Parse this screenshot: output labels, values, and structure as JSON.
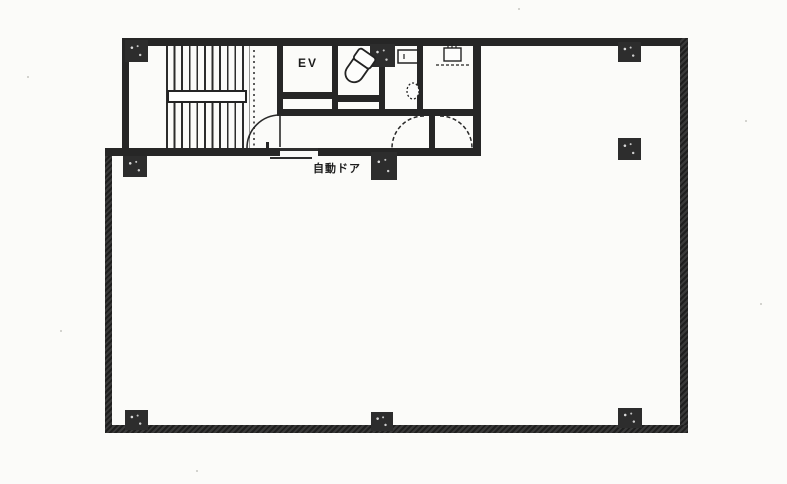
{
  "document": {
    "type": "floor-plan",
    "description": "Scanned monochrome building floor plan: stairwell, elevator, toilet core at top-left, large open room below"
  },
  "labels": {
    "elevator": "EV",
    "automatic_door": "自動ドア"
  },
  "colors": {
    "paper": "#fbfbf9",
    "ink": "#262626",
    "pillar": "#2d2d2d"
  },
  "rooms": {
    "stairwell": "staircase with central handrail",
    "elevator_shaft": "EV",
    "toilet": "toilet with bowl fixture",
    "service_room": "room with urinal trough and wall basin",
    "kitchenette": "room with sink and counter",
    "main_room": "large open tenant space with 3x3 pillar grid"
  }
}
